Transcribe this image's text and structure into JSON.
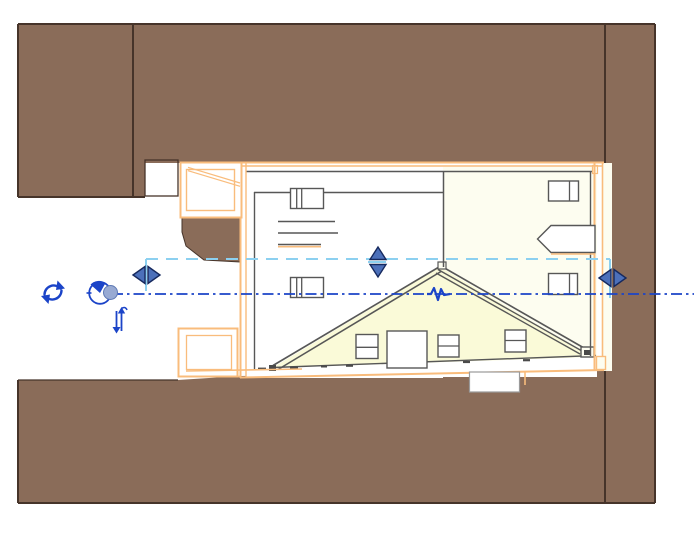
{
  "app": {
    "name": "cad-site-plan-view",
    "view_type": "plan view with selected building element"
  },
  "colors": {
    "terrain": "#8A6C59",
    "terrain-alt": "#857061",
    "terrain-border": "#46342A",
    "wall-orange": "#F9BC7C",
    "line-gray": "#575757",
    "paper-white": "#FFFFFF",
    "cream": "#FDFDF0",
    "roof-yellow": "#FAFAD8",
    "control-blue": "#4C70BA",
    "control-blue-dark": "#16295E",
    "ref-blue": "#1B44C8",
    "select-cyan": "#8CD0F0",
    "grip-fill": "#98AAD3",
    "eave-dark": "#4A4A4A"
  },
  "controls": {
    "rotate": {
      "icon": "rotate-icon"
    },
    "rotation_center": {
      "icon": "rotation-center-grip"
    },
    "flip_vertical": {
      "icon": "flip-vertical-icon"
    },
    "flip_left_right_west": {
      "icon": "flip-arrows-horizontal"
    },
    "flip_up_down_center": {
      "icon": "flip-arrows-vertical"
    },
    "flip_left_right_east": {
      "icon": "flip-arrows-horizontal"
    },
    "reference_line": {
      "style": "dash-dot"
    },
    "jog_symbol": {
      "style": "zigzag"
    },
    "selection_extent_box": {
      "style": "dashed"
    }
  },
  "scene": {
    "regions": [
      "terrain-top",
      "terrain-left-block",
      "terrain-right-strip",
      "terrain-bottom-band",
      "terrain-step-block",
      "terrain-notch"
    ],
    "building": [
      "balcony-upper",
      "balcony-lower",
      "left-room",
      "right-room",
      "roof-gable",
      "porch"
    ],
    "symbols": [
      "window-symbol-1",
      "stair-shelf-lines",
      "window-symbol-2",
      "window-symbol-3",
      "counter-arrow",
      "window-symbol-4",
      "fixture-1",
      "fixture-2",
      "fixture-3",
      "fixture-4"
    ]
  }
}
